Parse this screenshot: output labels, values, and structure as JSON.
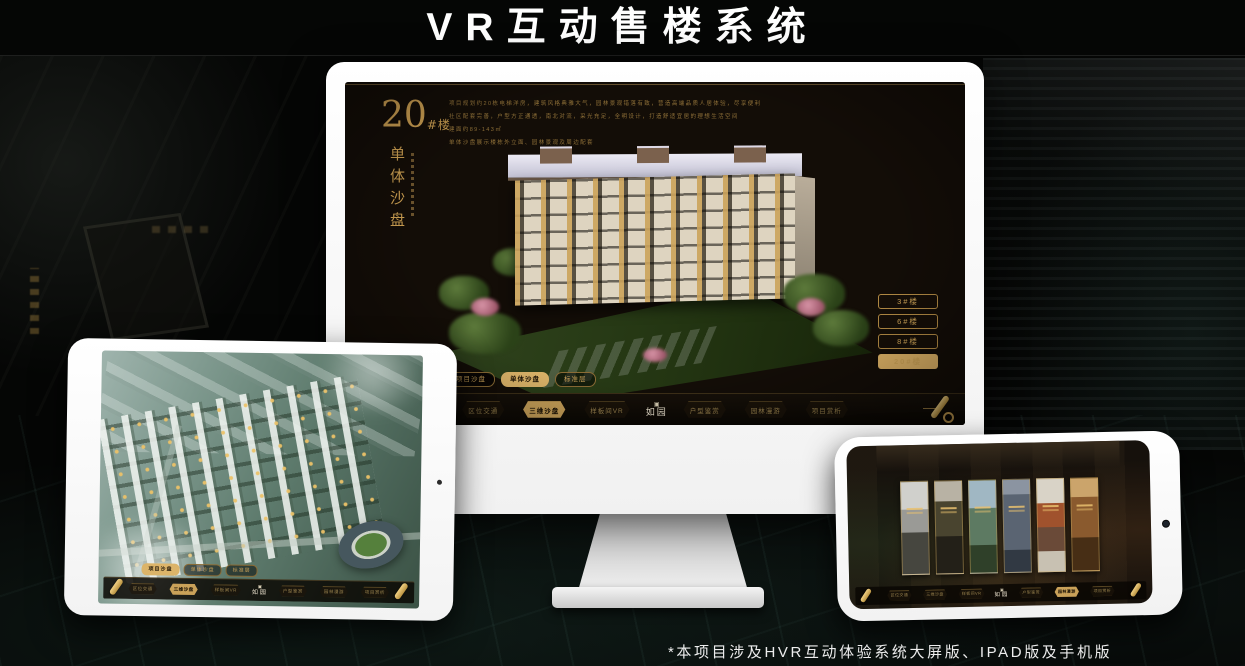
{
  "page": {
    "title": "VR互动售楼系统",
    "footnote": "*本项目涉及HVR互动体验系统大屏版、IPAD版及手机版"
  },
  "colors": {
    "gold": "#c9a159",
    "gold_bright": "#ddb266",
    "screen_bg": "#130d07",
    "frame_white": "#f7f7f7"
  },
  "icons": {
    "seal": "▣"
  },
  "monitor": {
    "building_no": "20",
    "building_no_suffix": "#楼",
    "section_title": "单体沙盘",
    "description": [
      "项目规划约20栋电梯洋房，建筑风格典雅大气，园林景观错落有致，营造高端品质人居体验，尽享便利",
      "社区配套完善，户型方正通透，南北对流，采光充足，全明设计，打造舒适宜居的理想生活空间",
      "建面约89-143㎡",
      "单体沙盘展示楼栋外立面、园林景观及周边配套"
    ],
    "floor_buttons": [
      {
        "label": "3#楼",
        "selected": false
      },
      {
        "label": "6#楼",
        "selected": false
      },
      {
        "label": "8#楼",
        "selected": false
      },
      {
        "label": "20#楼",
        "selected": true
      }
    ],
    "subtabs": [
      {
        "label": "项目沙盘",
        "selected": false
      },
      {
        "label": "单体沙盘",
        "selected": true
      },
      {
        "label": "标准层",
        "selected": false
      }
    ],
    "nav": {
      "logo": "如园",
      "items": [
        {
          "label": "区位交通",
          "selected": false
        },
        {
          "label": "三维沙盘",
          "selected": true
        },
        {
          "label": "样板间VR",
          "selected": false
        },
        {
          "label": "户型鉴赏",
          "selected": false
        },
        {
          "label": "园林漫游",
          "selected": false
        },
        {
          "label": "项目赏析",
          "selected": false
        }
      ]
    }
  },
  "tablet": {
    "subtabs": [
      {
        "label": "项目沙盘",
        "selected": true
      },
      {
        "label": "单体沙盘",
        "selected": false
      },
      {
        "label": "标准层",
        "selected": false
      }
    ],
    "nav": {
      "logo": "如园",
      "items": [
        {
          "label": "区位交通",
          "selected": false
        },
        {
          "label": "三维沙盘",
          "selected": true
        },
        {
          "label": "样板间VR",
          "selected": false
        },
        {
          "label": "户型鉴赏",
          "selected": false
        },
        {
          "label": "园林漫游",
          "selected": false
        },
        {
          "label": "项目赏析",
          "selected": false
        }
      ]
    }
  },
  "phone": {
    "nav": {
      "logo": "如园",
      "items": [
        {
          "label": "区位交通",
          "selected": false
        },
        {
          "label": "三维沙盘",
          "selected": false
        },
        {
          "label": "样板间VR",
          "selected": false
        },
        {
          "label": "户型鉴赏",
          "selected": false
        },
        {
          "label": "园林漫游",
          "selected": true
        },
        {
          "label": "项目赏析",
          "selected": false
        }
      ]
    }
  }
}
